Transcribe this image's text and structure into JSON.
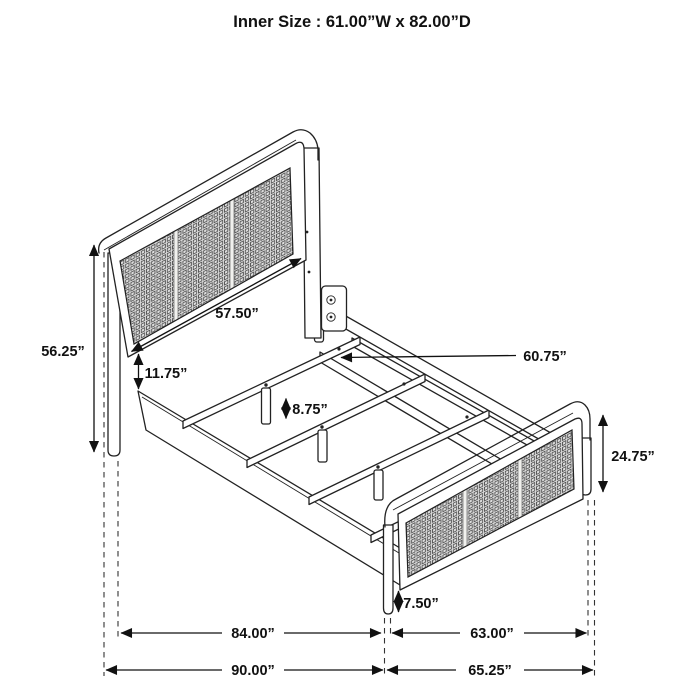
{
  "title": "Inner Size : 61.00”W x 82.00”D",
  "dimensions": {
    "headboard_height": "56.25”",
    "headboard_width": "57.50”",
    "headboard_gap": "11.75”",
    "center_rail_length": "60.75”",
    "slat_support_height": "8.75”",
    "footboard_height": "24.75”",
    "footboard_clearance": "7.50”",
    "inner_length": "84.00”",
    "inner_width": "63.00”",
    "outer_length": "90.00”",
    "outer_width": "65.25”"
  },
  "colors": {
    "line": "#222222",
    "dimension_line": "#111111",
    "mesh_fill": "#dedede",
    "mesh_weave": "#4a4a4a",
    "background": "#ffffff"
  }
}
